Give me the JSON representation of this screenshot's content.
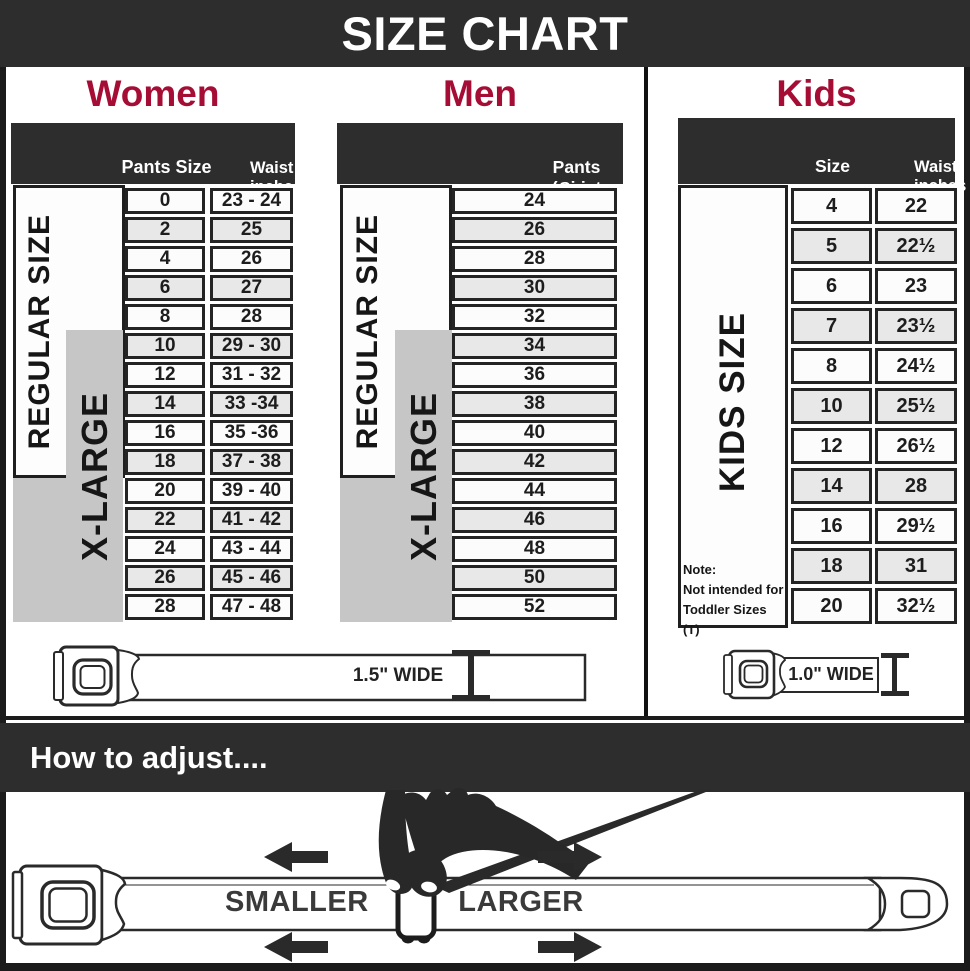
{
  "title": "SIZE CHART",
  "colors": {
    "banner": "#2d2d2d",
    "accent_red": "#a50d35",
    "row_alt": "#e8e8e8",
    "xlarge_gray": "#c6c6c6"
  },
  "sections": {
    "women": {
      "heading": "Women",
      "col_pants": "Pants Size",
      "col_waist_line1": "Waist",
      "col_waist_line2": "inches",
      "regular_label": "REGULAR SIZE",
      "xlarge_label": "X-LARGE",
      "rows": [
        {
          "pants": "0",
          "waist": "23 - 24"
        },
        {
          "pants": "2",
          "waist": "25"
        },
        {
          "pants": "4",
          "waist": "26"
        },
        {
          "pants": "6",
          "waist": "27"
        },
        {
          "pants": "8",
          "waist": "28"
        },
        {
          "pants": "10",
          "waist": "29 - 30"
        },
        {
          "pants": "12",
          "waist": "31 - 32"
        },
        {
          "pants": "14",
          "waist": "33 -34"
        },
        {
          "pants": "16",
          "waist": "35 -36"
        },
        {
          "pants": "18",
          "waist": "37 - 38"
        },
        {
          "pants": "20",
          "waist": "39 - 40"
        },
        {
          "pants": "22",
          "waist": "41 - 42"
        },
        {
          "pants": "24",
          "waist": "43 - 44"
        },
        {
          "pants": "26",
          "waist": "45 - 46"
        },
        {
          "pants": "28",
          "waist": "47 - 48"
        }
      ]
    },
    "men": {
      "heading": "Men",
      "col_header_line1": "Pants Size",
      "col_header_line2": "(waist inches)",
      "regular_label": "REGULAR SIZE",
      "xlarge_label": "X-LARGE",
      "rows": [
        "24",
        "26",
        "28",
        "30",
        "32",
        "34",
        "36",
        "38",
        "40",
        "42",
        "44",
        "46",
        "48",
        "50",
        "52"
      ]
    },
    "kids": {
      "heading": "Kids",
      "col_size": "Size",
      "col_waist_line1": "Waist",
      "col_waist_line2": "inches",
      "side_label": "KIDS SIZE",
      "note_line1": "Note:",
      "note_line2": "Not intended for",
      "note_line3": "Toddler Sizes (T)",
      "rows": [
        {
          "size": "4",
          "waist": "22"
        },
        {
          "size": "5",
          "waist": "22½"
        },
        {
          "size": "6",
          "waist": "23"
        },
        {
          "size": "7",
          "waist": "23½"
        },
        {
          "size": "8",
          "waist": "24½"
        },
        {
          "size": "10",
          "waist": "25½"
        },
        {
          "size": "12",
          "waist": "26½"
        },
        {
          "size": "14",
          "waist": "28"
        },
        {
          "size": "16",
          "waist": "29½"
        },
        {
          "size": "18",
          "waist": "31"
        },
        {
          "size": "20",
          "waist": "32½"
        }
      ]
    }
  },
  "belts": {
    "adult_width_label": "1.5\" WIDE",
    "kids_width_label": "1.0\" WIDE"
  },
  "adjust": {
    "heading": "How to adjust....",
    "smaller_label": "SMALLER",
    "larger_label": "LARGER"
  }
}
